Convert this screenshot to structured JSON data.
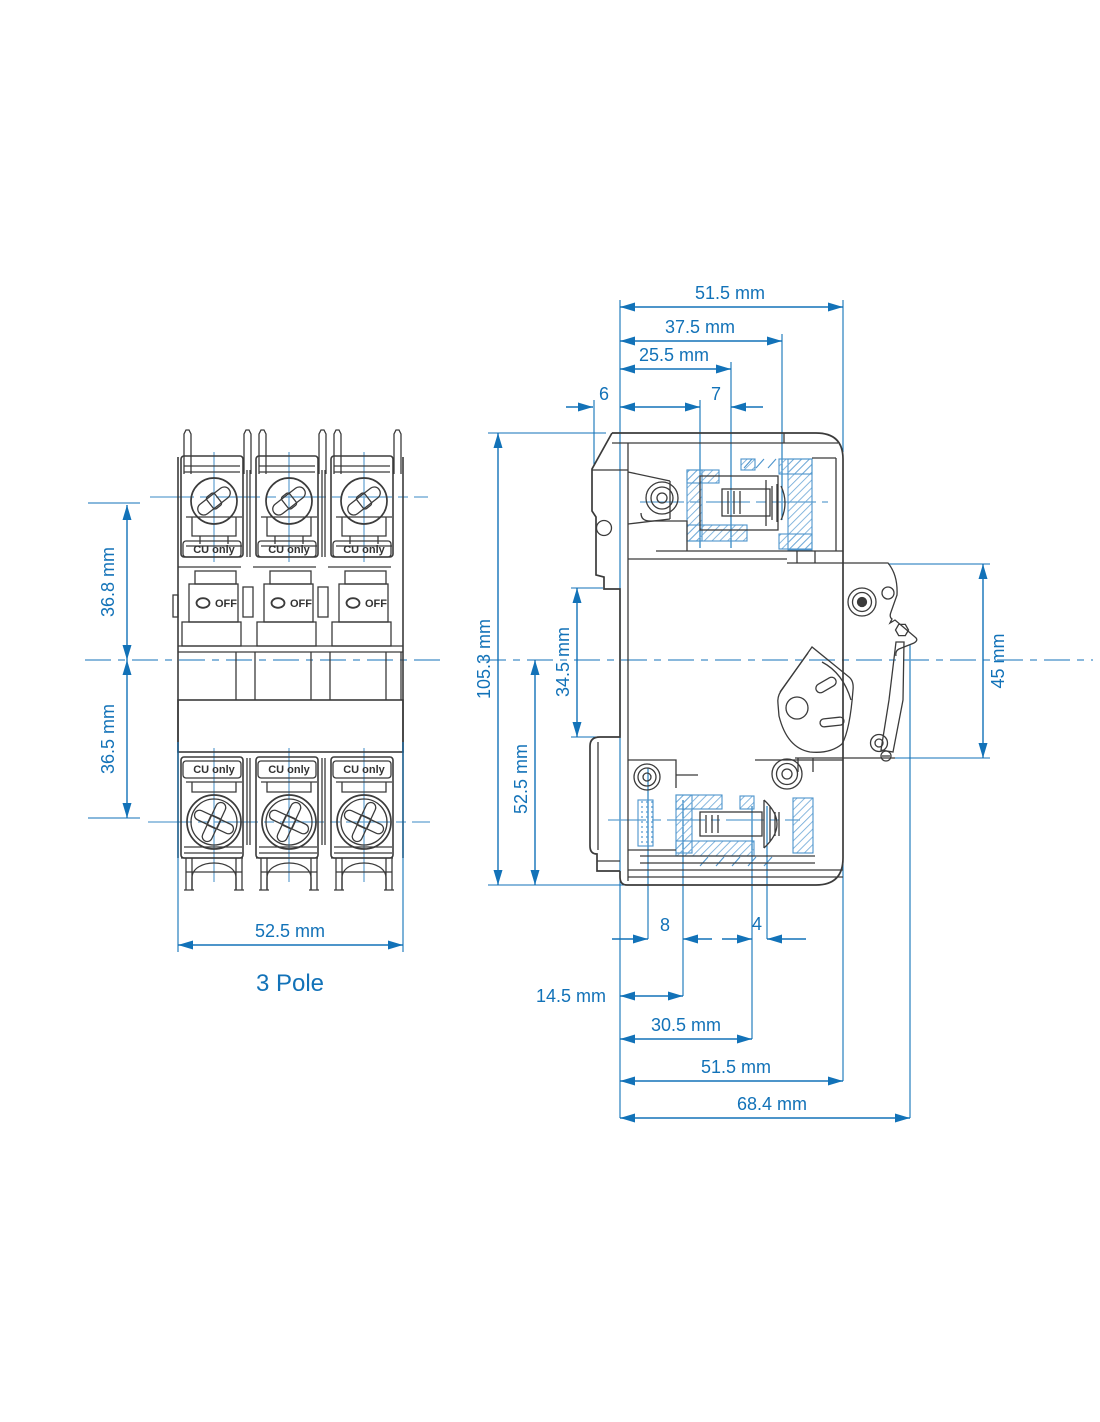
{
  "drawing_type": "circuit-breaker dimensional drawing",
  "colors": {
    "dimension_blue": "#1272b8",
    "centerline_blue": "#62a0d0",
    "hatch_blue": "#72abd8",
    "line_dark": "#3b3b3b"
  },
  "front": {
    "caption": "3 Pole",
    "terminal_label": "CU only",
    "switch_label": "OFF",
    "dims": {
      "upper": "36.8 mm",
      "lower": "36.5 mm",
      "width": "52.5 mm"
    }
  },
  "side": {
    "top_dims": {
      "overall": "51.5 mm",
      "mid": "37.5 mm",
      "inner": "25.5 mm",
      "flange": "6",
      "opening": "7"
    },
    "left_dims": {
      "height": "105.3 mm",
      "recess": "34.5 mm",
      "lower": "52.5 mm"
    },
    "right_dims": {
      "mechanism": "45 mm"
    },
    "bottom_dims": {
      "d8": "8",
      "d4": "4",
      "d14_5": "14.5 mm",
      "d30_5": "30.5 mm",
      "width": "51.5 mm",
      "depth": "68.4 mm"
    }
  }
}
